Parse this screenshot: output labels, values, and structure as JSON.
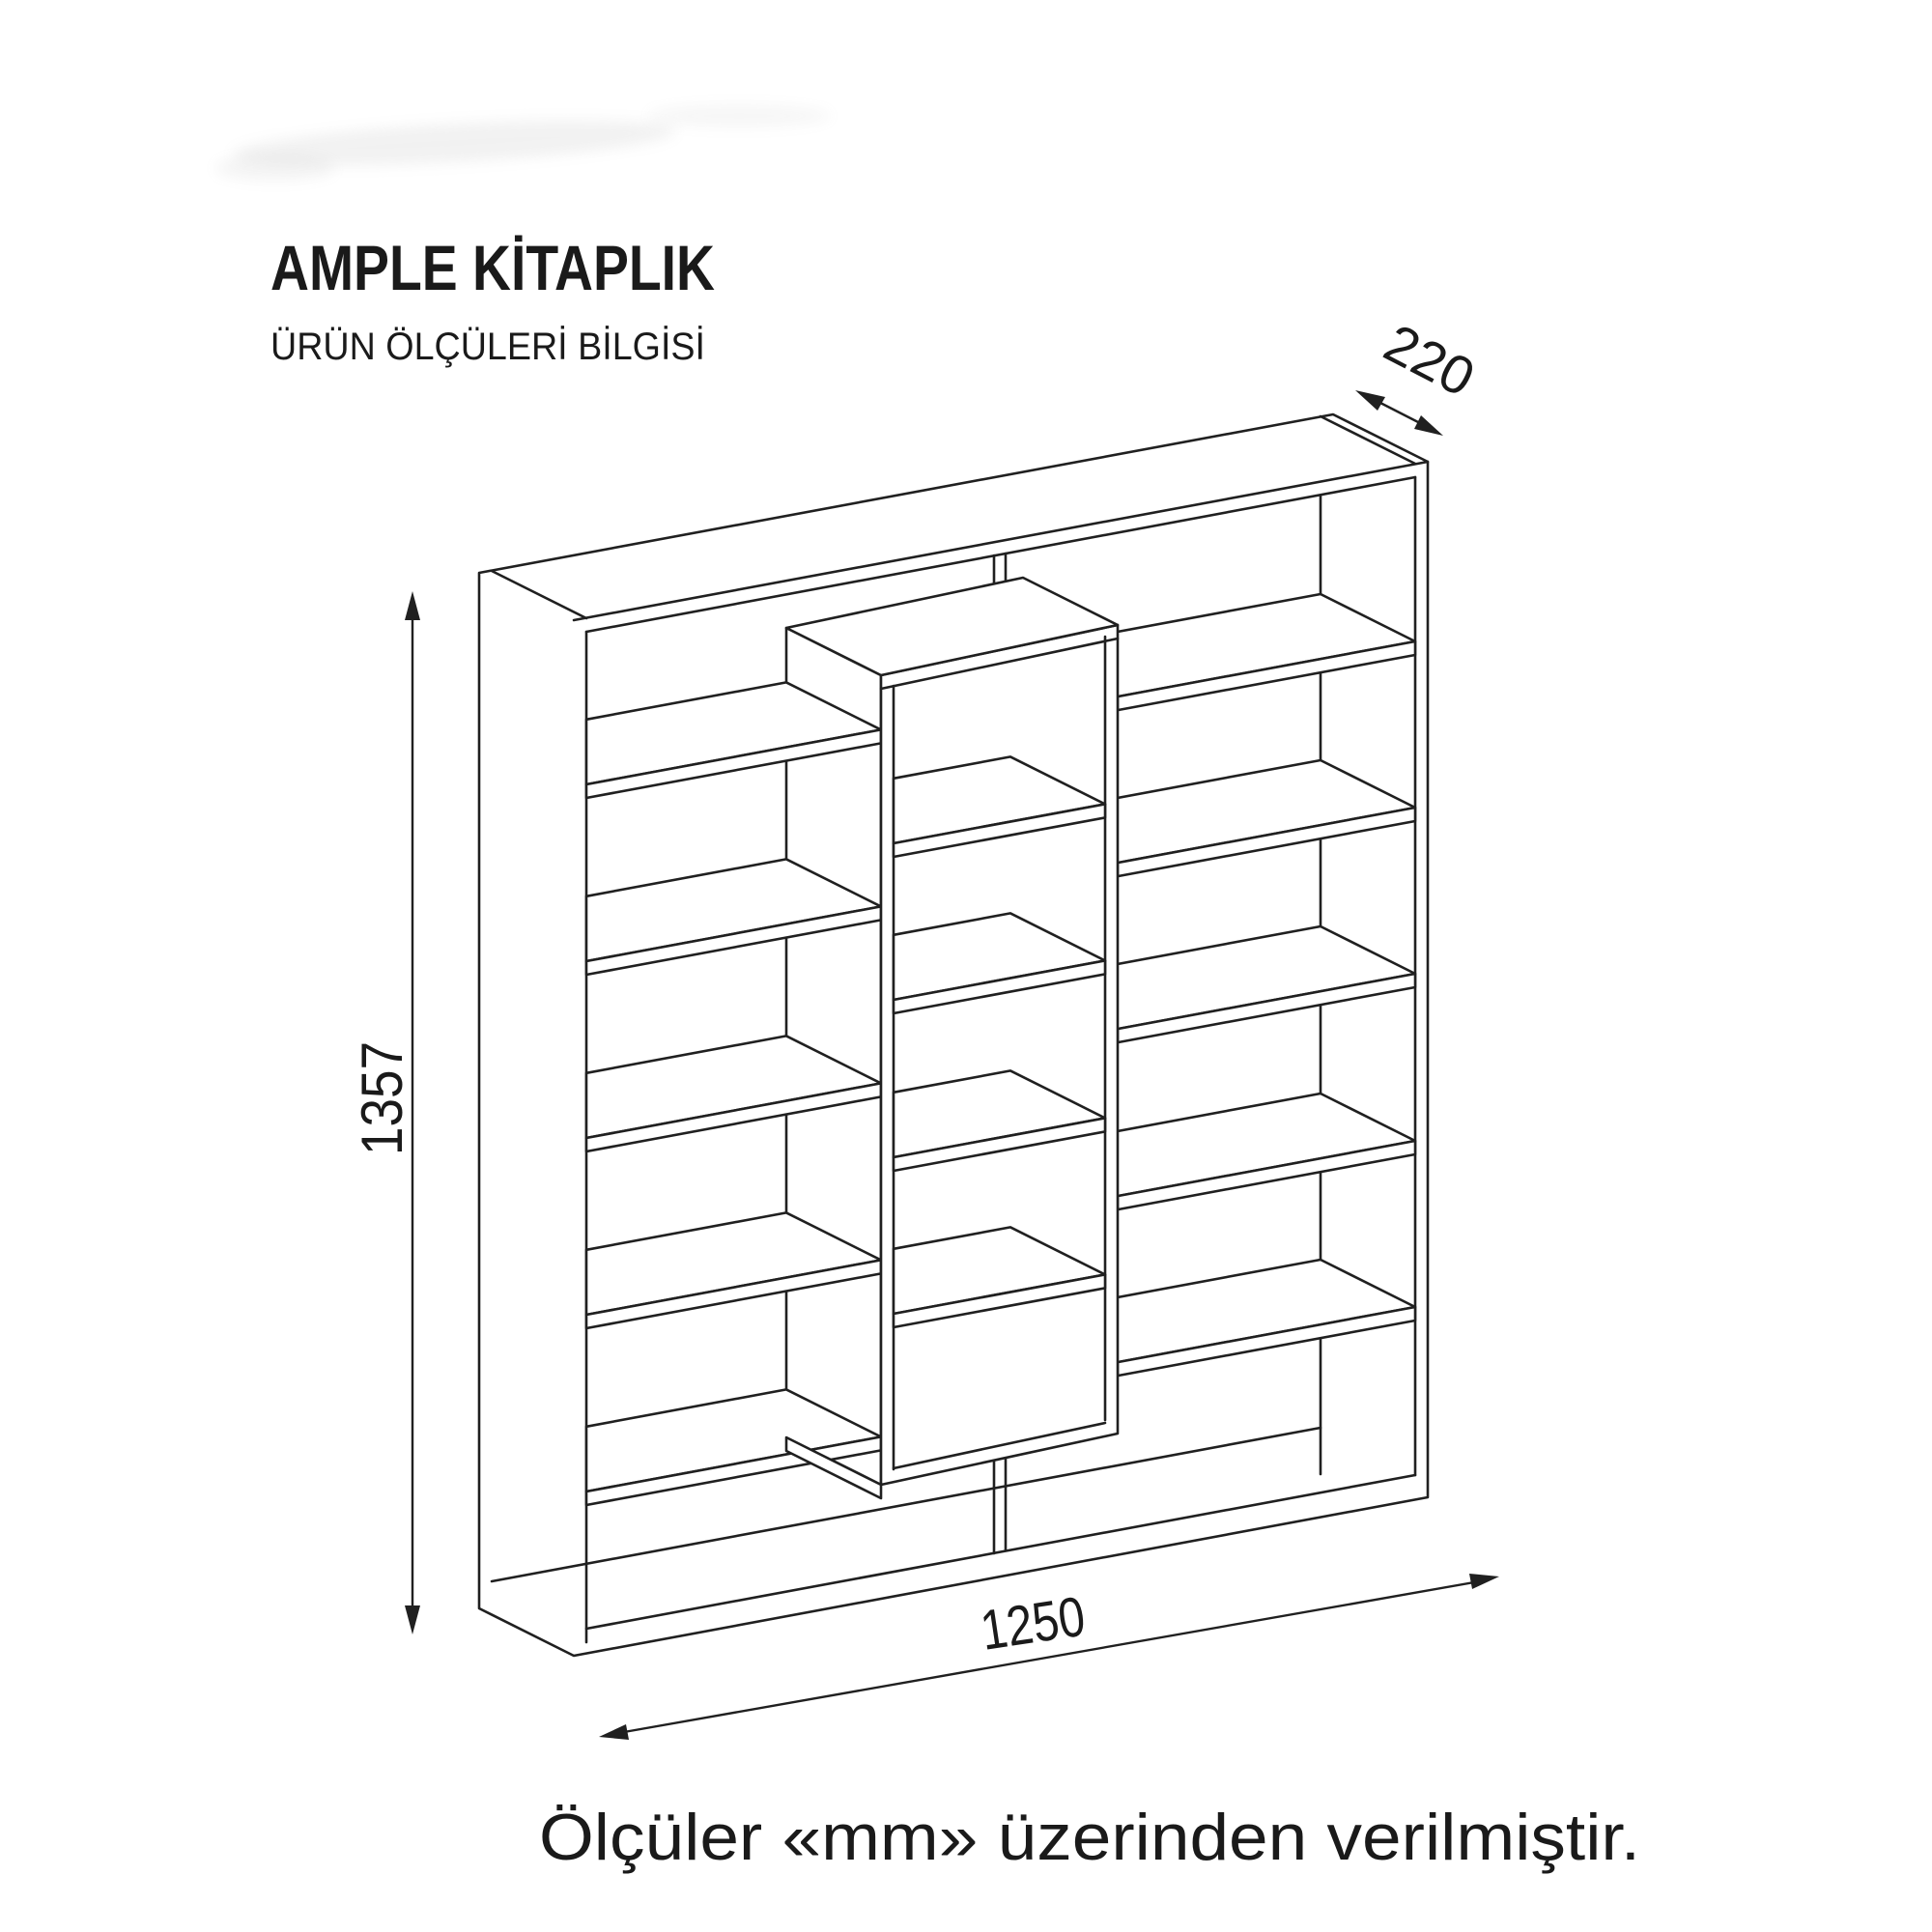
{
  "page": {
    "title": "AMPLE KİTAPLIK",
    "subtitle": "ÜRÜN ÖLÇÜLERİ BİLGİSİ",
    "footer": "Ölçüler «mm» üzerinden verilmiştir."
  },
  "dimensions": {
    "depth_mm": "220",
    "height_mm": "1357",
    "width_mm": "1250",
    "unit": "mm"
  },
  "drawing": {
    "object": "bookshelf-line-drawing",
    "line_color": "#202020",
    "background": "#ffffff"
  }
}
